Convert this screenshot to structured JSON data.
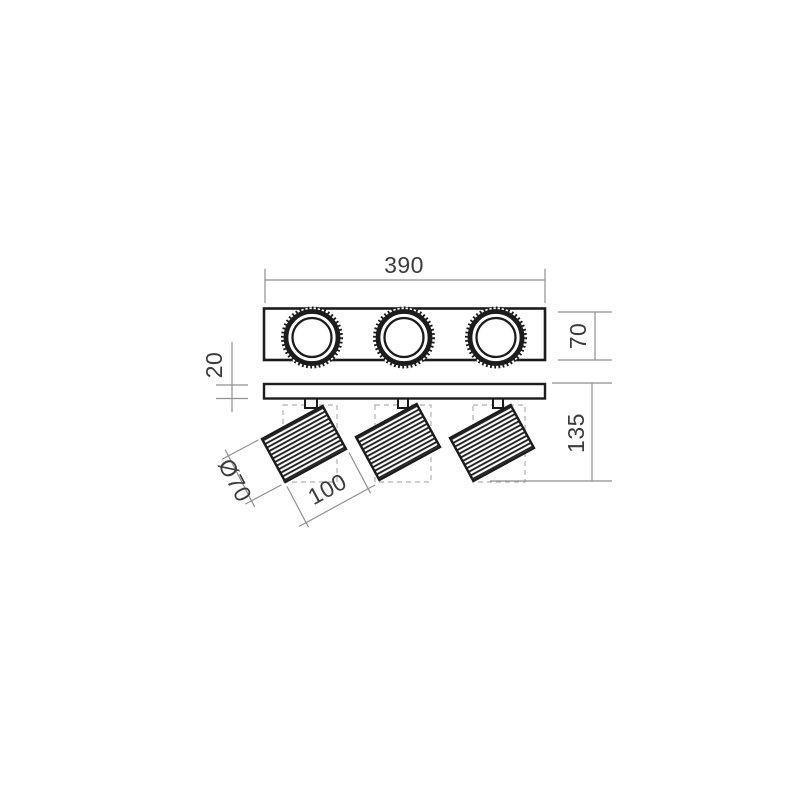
{
  "drawing": {
    "name": "triple-spotlight-ceiling-fixture-dimension-drawing",
    "views": {
      "top_view": "mounting plate with three knurled ring spot bezels",
      "side_view": "mounting plate with three tilted cylindrical spot heads"
    },
    "dimensions": {
      "overall_width": "390",
      "plate_depth": "70",
      "canopy_thickness": "20",
      "overall_height": "135",
      "head_diameter": "Ø70",
      "head_length": "100"
    },
    "colors": {
      "outline": "#1c1c1c",
      "dimension_line": "#8f8f8f",
      "hidden_line": "#b0b0b0",
      "label": "#3b3b3b",
      "background": "#ffffff"
    }
  }
}
